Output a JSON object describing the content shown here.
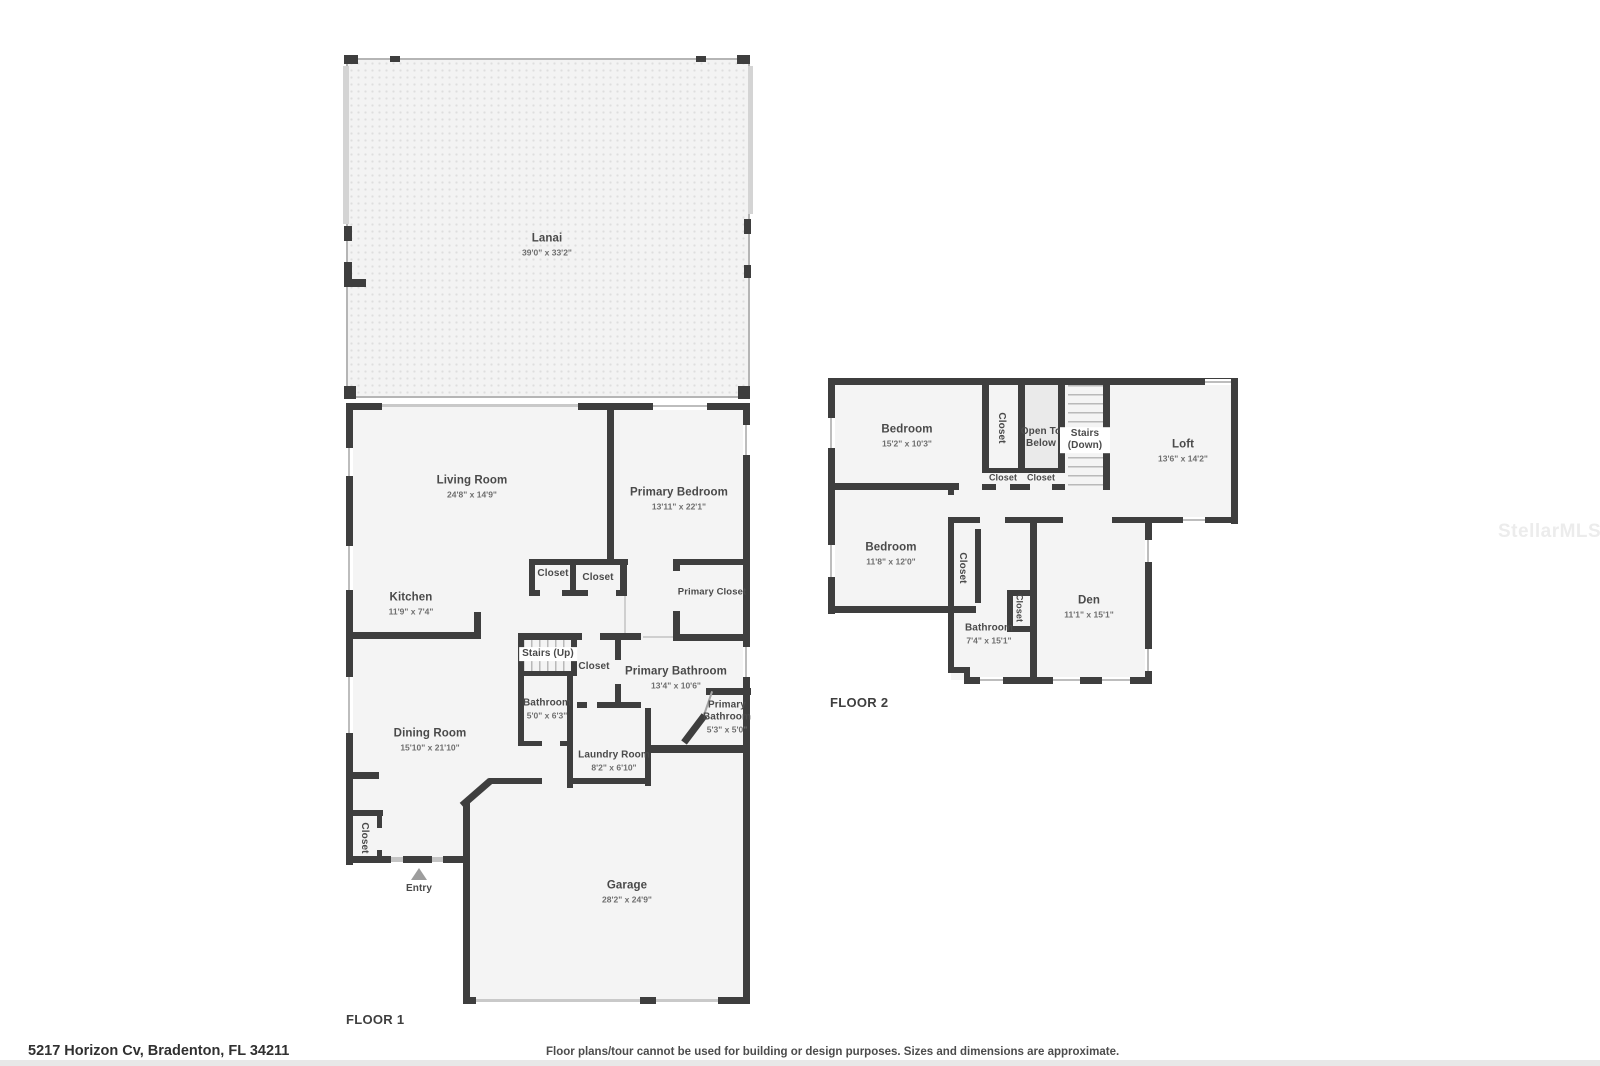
{
  "watermark": "StellarMLS",
  "footer": {
    "address": "5217 Horizon Cv, Bradenton, FL 34211",
    "disclaimer": "Floor plans/tour cannot be used for building or design purposes. Sizes and dimensions are approximate."
  },
  "colors": {
    "wall": "#3e3e3e",
    "floor_fill": "#f4f4f4",
    "lanai_fill": "#f3f3f3",
    "window_marker": "#bdbdbd",
    "label_text": "#4a4a4a"
  },
  "floor1": {
    "label": "FLOOR 1",
    "rooms": {
      "lanai": {
        "name": "Lanai",
        "dims": "39'0\" x 33'2\""
      },
      "living_room": {
        "name": "Living Room",
        "dims": "24'8\" x 14'9\""
      },
      "primary_bedroom": {
        "name": "Primary Bedroom",
        "dims": "13'11\" x 22'1\""
      },
      "kitchen": {
        "name": "Kitchen",
        "dims": "11'9\" x 7'4\""
      },
      "closet_a": {
        "name": "Closet"
      },
      "closet_b": {
        "name": "Closet"
      },
      "primary_closet": {
        "name": "Primary Closet"
      },
      "stairs": {
        "name": "Stairs (Up)"
      },
      "hall_closet": {
        "name": "Closet"
      },
      "bathroom": {
        "name": "Bathroom",
        "dims": "5'0\" x 6'3\""
      },
      "primary_bathroom": {
        "name": "Primary Bathroom",
        "dims": "13'4\" x 10'6\""
      },
      "primary_bathroom_2": {
        "name": "Primary Bathroom",
        "dims": "5'3\" x 5'0\""
      },
      "dining_room": {
        "name": "Dining Room",
        "dims": "15'10\" x 21'10\""
      },
      "laundry_room": {
        "name": "Laundry Room",
        "dims": "8'2\" x 6'10\""
      },
      "entry_closet": {
        "name": "Closet"
      },
      "garage": {
        "name": "Garage",
        "dims": "28'2\" x 24'9\""
      },
      "entry": {
        "name": "Entry"
      }
    }
  },
  "floor2": {
    "label": "FLOOR 2",
    "rooms": {
      "bedroom_1": {
        "name": "Bedroom",
        "dims": "15'2\" x 10'3\""
      },
      "closet_1": {
        "name": "Closet"
      },
      "open_to_below": {
        "name": "Open To Below"
      },
      "stairs": {
        "name": "Stairs (Down)"
      },
      "loft": {
        "name": "Loft",
        "dims": "13'6\" x 14'2\""
      },
      "closet_2": {
        "name": "Closet"
      },
      "closet_3": {
        "name": "Closet"
      },
      "bedroom_2": {
        "name": "Bedroom",
        "dims": "11'8\" x 12'0\""
      },
      "closet_4": {
        "name": "Closet"
      },
      "bathroom": {
        "name": "Bathroom",
        "dims": "7'4\" x 15'1\""
      },
      "closet_5": {
        "name": "Closet"
      },
      "den": {
        "name": "Den",
        "dims": "11'1\" x 15'1\""
      }
    }
  }
}
